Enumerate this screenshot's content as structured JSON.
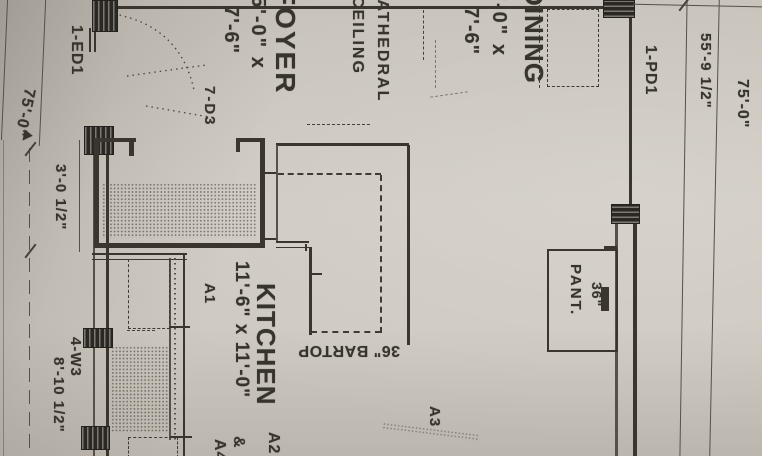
{
  "plan": {
    "dimensions": {
      "left_top": "75'-0\"",
      "stair_width": "3'-0 1/2\"",
      "window_width": "8'-10 1/2\"",
      "right_partial": "55'-9 1/2\"",
      "right_total": "75'-0\""
    },
    "doors_windows": {
      "entry_door": "1-ED1",
      "door_d3": "7-D3",
      "pocket_door": "1-PD1",
      "window_w3": "4-W3"
    },
    "rooms": {
      "foyer": {
        "name": "FOYER",
        "size_line1": "5'-0\" x",
        "size_line2": "7'-6\""
      },
      "dining": {
        "name": "DINING",
        "size_line1": "15'-0\" x",
        "size_line2": "7'-6\""
      },
      "kitchen": {
        "name": "KITCHEN",
        "size": "11'-6\" x 11'-0\""
      },
      "ceiling_note_line1": "CATHEDRAL",
      "ceiling_note_line2": "CEILING",
      "bartop": "36\" BARTOP",
      "pantry_width": "36\"",
      "pantry_name": "PANT."
    },
    "markers": {
      "a1": "A1",
      "a2": "A2",
      "amp": "&",
      "a3": "A3",
      "a4": "A4"
    },
    "icons": {
      "dimension_arrow": "▶"
    }
  }
}
